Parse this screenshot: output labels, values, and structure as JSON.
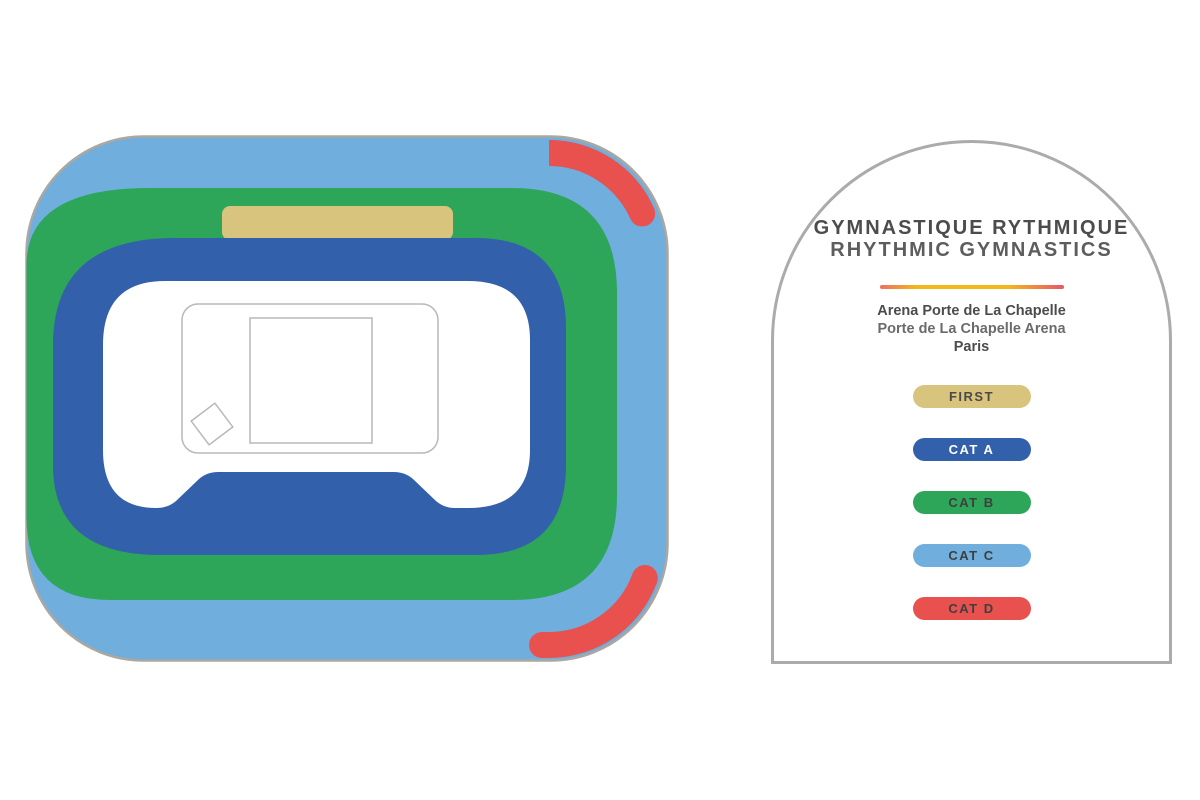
{
  "legend": {
    "title_fr": "GYMNASTIQUE RYTHMIQUE",
    "title_en": "RHYTHMIC GYMNASTICS",
    "venue_fr": "Arena Porte de La Chapelle",
    "venue_en": "Porte de La Chapelle Arena",
    "city": "Paris",
    "divider_colors": [
      "#ee6f5f",
      "#f3b71c",
      "#e9556b"
    ],
    "categories": [
      {
        "id": "first",
        "label": "FIRST",
        "color": "#d8c47d",
        "text_color": "#4a4a4a"
      },
      {
        "id": "cat-a",
        "label": "CAT A",
        "color": "#3360aa",
        "text_color": "#ffffff"
      },
      {
        "id": "cat-b",
        "label": "CAT B",
        "color": "#2da65a",
        "text_color": "#3f3f3f"
      },
      {
        "id": "cat-c",
        "label": "CAT C",
        "color": "#6faedd",
        "text_color": "#3f3f3f"
      },
      {
        "id": "cat-d",
        "label": "CAT D",
        "color": "#e8514e",
        "text_color": "#3f3f3f"
      }
    ]
  },
  "arena": {
    "tiers": [
      {
        "name": "CAT C",
        "color": "#6faedd"
      },
      {
        "name": "CAT D",
        "color": "#e8514e"
      },
      {
        "name": "CAT B",
        "color": "#2da65a"
      },
      {
        "name": "FIRST",
        "color": "#d8c47d"
      },
      {
        "name": "CAT A",
        "color": "#3360aa"
      }
    ],
    "floor_color": "#ffffff",
    "outline_color": "#aba7a1",
    "floor_outline_color": "#b8b8b8"
  }
}
